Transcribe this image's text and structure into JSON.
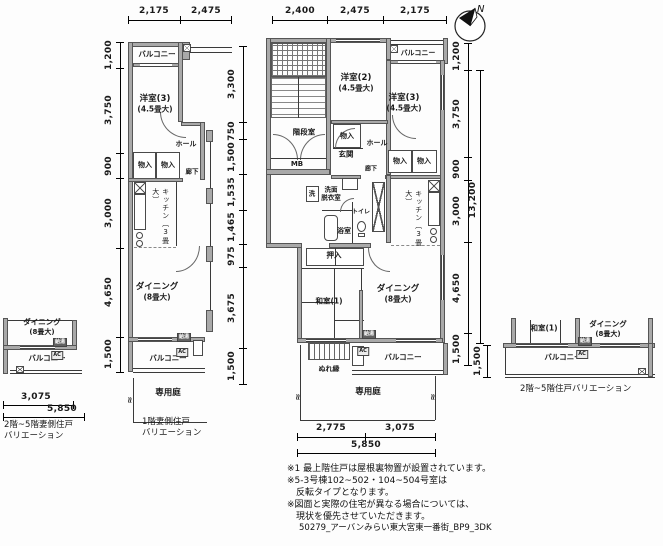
{
  "compass": {
    "n": "N"
  },
  "left_plan": {
    "dim_top_1": "2,175",
    "dim_top_2": "2,475",
    "dim_l_1": "1,200",
    "dim_l_2": "3,750",
    "dim_l_3": "900",
    "dim_l_4": "3,000",
    "dim_l_5": "4,650",
    "dim_l_6": "1,500",
    "balcony_top": "バルコニー",
    "bedroom3": "洋室(3)",
    "bedroom3_size": "(4.5畳大)",
    "hall": "ホール",
    "closet_a": "物入",
    "closet_b": "物入",
    "corridor": "廊下",
    "kitchen": "キッチン",
    "kitchen_size": "〔3畳大〕",
    "dining": "ダイニング",
    "dining_size": "(8畳大)",
    "heater_badge": "給湯",
    "ac_badge": "AC",
    "balcony_bottom": "バルコニー",
    "garden": "専用庭",
    "caption_1": "1階妻側住戸",
    "caption_2": "バリエーション"
  },
  "mid_plan": {
    "dim_top_1": "2,400",
    "dim_top_2": "2,475",
    "dim_top_3": "2,175",
    "dim_l_1": "3,300",
    "dim_l_2": "750",
    "dim_l_3": "1,500",
    "dim_l_4": "1,535",
    "dim_l_5": "1,465",
    "dim_l_6": "975",
    "dim_l_7": "3,675",
    "dim_l_8": "1,500",
    "dim_r_1": "1,200",
    "dim_r_2": "3,750",
    "dim_r_3": "900",
    "dim_r_4": "3,000",
    "dim_r_total": "13,200",
    "dim_r_5": "4,650",
    "dim_r_6": "1,500",
    "dim_b_1": "2,775",
    "dim_b_2": "3,075",
    "dim_b_total": "5,850",
    "stairwell": "階段室",
    "mb": "MB",
    "bedroom2": "洋室(2)",
    "bedroom2_size": "(4.5畳大)",
    "balcony_top": "バルコニー",
    "bedroom3": "洋室(3)",
    "bedroom3_size": "(4.5畳大)",
    "closet_a": "物入",
    "hall": "ホール",
    "entrance": "玄関",
    "closet_b": "物入",
    "closet_c": "物入",
    "corridor": "廊下",
    "washer": "洗",
    "washroom_1": "洗面",
    "washroom_2": "脱衣室",
    "toilet": "トイレ",
    "bath": "浴室",
    "kitchen": "キッチン",
    "kitchen_size": "〔3畳大〕",
    "oshiire": "押入",
    "tatami_room": "和室(1)",
    "dining": "ダイニング",
    "dining_size": "(8畳大)",
    "nureen": "ぬれ縁",
    "heater_badge": "給湯",
    "ac_badge": "AC",
    "balcony_bottom": "バルコニー",
    "garden": "専用庭"
  },
  "left_var": {
    "dining": "ダイニング",
    "dining_size": "(8畳大)",
    "heater_badge": "給湯",
    "ac_badge": "AC",
    "balcony": "バルコニー",
    "dim_1": "3,075",
    "dim_total": "5,850",
    "caption_1": "2階~5階妻側住戸",
    "caption_2": "バリエーション"
  },
  "right_var": {
    "tatami_room": "和室(1)",
    "dining": "ダイニング",
    "dining_size": "(8畳大)",
    "heater_badge": "給湯",
    "ac_badge": "AC",
    "balcony": "バルコニー",
    "dim_1": "1,500",
    "caption": "2階~5階住戸バリエーション"
  },
  "notes": {
    "line_1": "※1 最上階住戸は屋根裏物置が設置されています。",
    "line_2": "※5-3号棟102~502・104~504号室は",
    "line_3": "反転タイプとなります。",
    "line_4": "※図面と実際の住宅が異なる場合については、",
    "line_5": "現状を優先させていただきます。"
  },
  "footer": {
    "doc_id": "50279_アーバンみらい東大宮東一番街_BP9_3DK"
  }
}
